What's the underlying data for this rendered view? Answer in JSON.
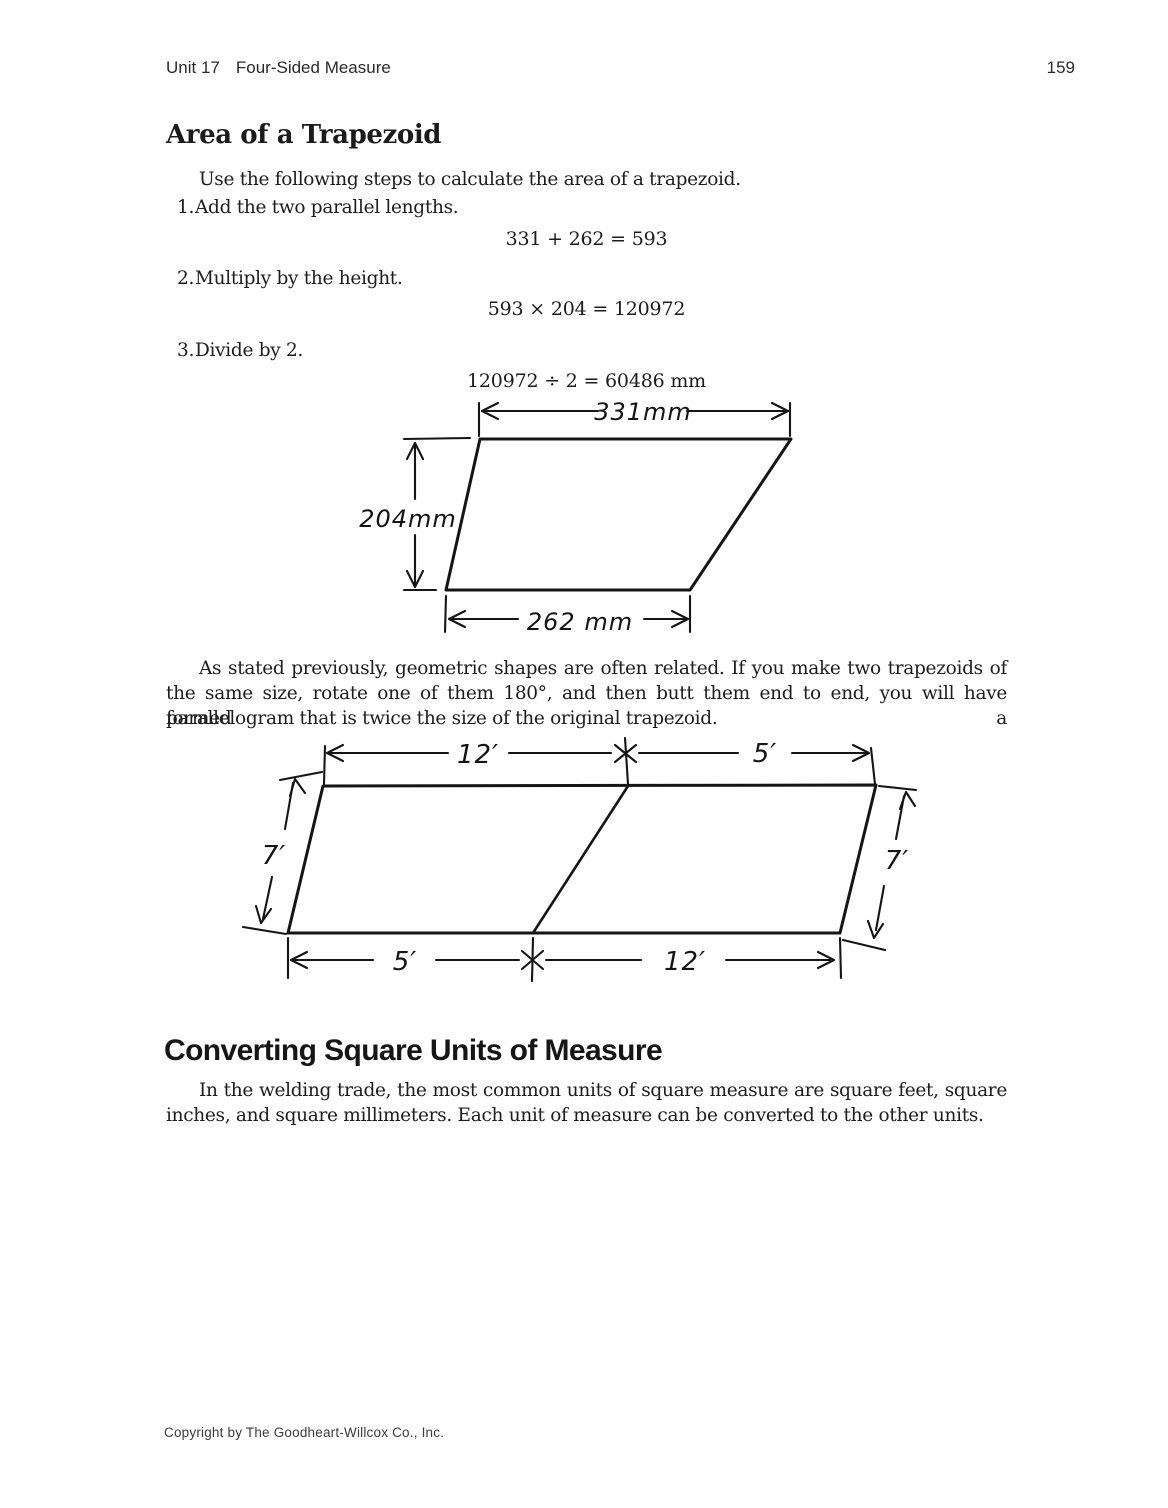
{
  "colors": {
    "ink": "#151515",
    "paper": "#fffefe"
  },
  "header": {
    "unit_label": "Unit 17",
    "unit_title": "Four-Sided Measure",
    "page_number": "159"
  },
  "section1": {
    "heading": "Area of a Trapezoid",
    "intro": "Use the following steps to calculate the area of a trapezoid.",
    "steps": [
      {
        "number": "1.",
        "text": "Add the two parallel lengths.",
        "equation": "331 + 262 = 593"
      },
      {
        "number": "2.",
        "text": "Multiply by the height.",
        "equation": "593 × 204 = 120972"
      },
      {
        "number": "3.",
        "text": "Divide by 2.",
        "equation": "120972 ÷ 2 = 60486 mm"
      }
    ],
    "paragraph_lines": [
      "As stated previously, geometric shapes are often related. If you make two trapezoids of",
      "the same size, rotate one of them 180°, and then butt them end to end, you will have formed a",
      "parallelogram that is twice the size of the original trapezoid."
    ]
  },
  "figure1": {
    "description": "trapezoid-with-dimensions",
    "top_label": "331mm",
    "height_label": "204mm",
    "bottom_label": "262 mm"
  },
  "figure2": {
    "description": "parallelogram-of-two-trapezoids",
    "top_left_label": "12′",
    "top_right_label": "5′",
    "left_label": "7′",
    "right_label": "7′",
    "bottom_left_label": "5′",
    "bottom_right_label": "12′"
  },
  "section2": {
    "heading": "Converting Square Units of Measure",
    "paragraph_lines": [
      "In the welding trade, the most common units of square measure are square feet, square",
      "inches, and square millimeters. Each unit of measure can be converted to the other units."
    ]
  },
  "footer": {
    "copyright": "Copyright by The Goodheart-Willcox Co., Inc."
  }
}
